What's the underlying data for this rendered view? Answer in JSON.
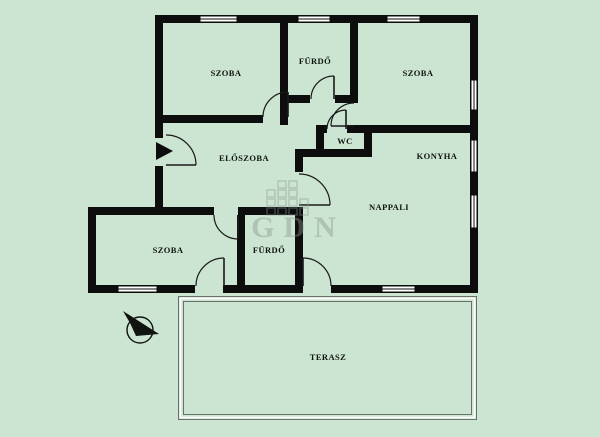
{
  "colors": {
    "background": "#cbe5d2",
    "wall": "#0d0d0d",
    "window_fill": "#ffffff",
    "terrace_line": "#6a6f6a",
    "watermark": "#8a938d"
  },
  "rooms": [
    {
      "id": "szoba-top-left",
      "label": "SZOBA"
    },
    {
      "id": "furdo-top",
      "label": "FÜRDŐ"
    },
    {
      "id": "szoba-top-right",
      "label": "SZOBA"
    },
    {
      "id": "eloszoba",
      "label": "ELŐSZOBA"
    },
    {
      "id": "wc",
      "label": "WC"
    },
    {
      "id": "konyha",
      "label": "KONYHA"
    },
    {
      "id": "nappali",
      "label": "NAPPALI"
    },
    {
      "id": "szoba-bottom",
      "label": "SZOBA"
    },
    {
      "id": "furdo-bottom",
      "label": "FÜRDŐ"
    },
    {
      "id": "terasz",
      "label": "TERASZ"
    }
  ],
  "watermark": {
    "text": "GDN"
  }
}
